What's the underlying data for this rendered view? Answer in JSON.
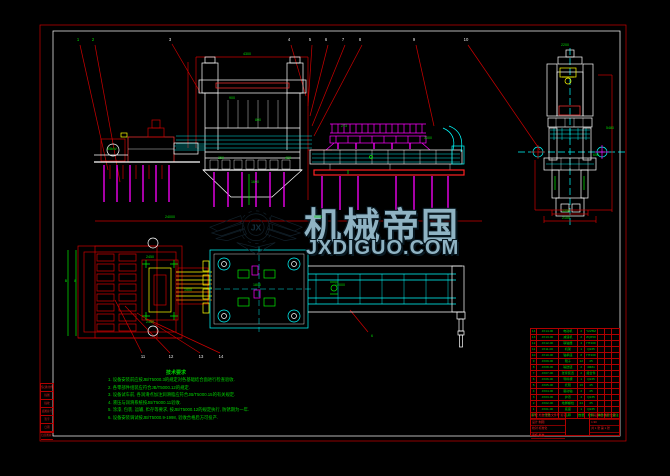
{
  "drawing": {
    "colors": {
      "background": "#000000",
      "frame_red": "#bb0000",
      "border_white": "#ffffff",
      "line_cyan": "#00ffff",
      "line_magenta": "#ff00ff",
      "line_green": "#00ee00",
      "line_yellow": "#ffff00",
      "watermark_blue": "#8fb3c3"
    },
    "watermark": {
      "title": "机械帝国",
      "site": "JXDIGUO.COM",
      "logo_monogram": "JX"
    },
    "notes": {
      "header": "技术要求",
      "lines": [
        "1. 设备安装前应按JB/T5000.3的规定对各基础结合面进行检查验收.",
        "2. 各零部件组装应符合JB/T5000.12的规定.",
        "3. 设备试车前, 各润滑点加注润滑脂应符合JB/T5000.15的有关规定.",
        "4. 液压与润滑系统按JB/T5000.11验收.",
        "5. 涂漆, 包装, 运输, 贮存等要求, 按JB/T5000.12的规定执行, 防锈期为一年.",
        "6. 设备安装调试按JB/T5000.9-1998, 验收合格后方可投产."
      ]
    },
    "bom": {
      "header": [
        "序号",
        "代号",
        "名称",
        "数量",
        "材料",
        "单件",
        "总计",
        "备注"
      ],
      "rows": [
        [
          "14",
          "JX14-00",
          "电动机",
          "2",
          "Y225M",
          "",
          "",
          ""
        ],
        [
          "13",
          "JX13-00",
          "减速机",
          "2",
          "ZQ650",
          "",
          "",
          ""
        ],
        [
          "12",
          "JX12-00",
          "联轴器",
          "4",
          "HT200",
          "",
          "",
          ""
        ],
        [
          "11",
          "JX11-00",
          "机架",
          "1",
          "Q235",
          "",
          "",
          ""
        ],
        [
          "10",
          "JX10-00",
          "轴承座",
          "8",
          "HT200",
          "",
          "",
          ""
        ],
        [
          "9",
          "JX09-00",
          "辊子",
          "12",
          "45",
          "",
          "",
          ""
        ],
        [
          "8",
          "JX08-00",
          "输送链",
          "2",
          "40Mn",
          "",
          "",
          ""
        ],
        [
          "7",
          "JX07-00",
          "张紧装置",
          "2",
          "组合件",
          "",
          "",
          ""
        ],
        [
          "6",
          "JX06-00",
          "导料槽",
          "1",
          "Q235",
          "",
          "",
          ""
        ],
        [
          "5",
          "JX05-00",
          "托辊",
          "16",
          "45",
          "",
          "",
          ""
        ],
        [
          "4",
          "JX04-00",
          "驱动轴",
          "2",
          "45",
          "",
          "",
          ""
        ],
        [
          "3",
          "JX03-00",
          "护罩",
          "4",
          "Q235",
          "",
          "",
          ""
        ],
        [
          "2",
          "JX02-00",
          "地脚螺栓",
          "24",
          "35",
          "",
          "",
          ""
        ],
        [
          "1",
          "JX01-00",
          "底座",
          "1",
          "Q235",
          "",
          "",
          ""
        ]
      ]
    },
    "title_block": {
      "left_rows": [
        "标记 处数 更改文件号 签字 日期",
        "设计  制图",
        "校对  标准化",
        "审核  批准"
      ],
      "right_rows": [
        "阶段标记  重量  比例",
        "1:30",
        "共 1 张  第 1 张"
      ]
    },
    "side_table_rows": [
      "借(通)用件登记",
      "描图",
      "描校",
      "底图总号",
      "签字",
      "日期",
      "旧底图总号"
    ],
    "annotations": {
      "balloons": [
        {
          "x": 78,
          "y": 38,
          "t": "1",
          "g": true
        },
        {
          "x": 93,
          "y": 38,
          "t": "2",
          "g": true
        },
        {
          "x": 170,
          "y": 38,
          "t": "3",
          "g": false
        },
        {
          "x": 289,
          "y": 38,
          "t": "4",
          "g": false
        },
        {
          "x": 310,
          "y": 38,
          "t": "5",
          "g": false
        },
        {
          "x": 326,
          "y": 38,
          "t": "6",
          "g": false
        },
        {
          "x": 343,
          "y": 38,
          "t": "7",
          "g": false
        },
        {
          "x": 360,
          "y": 38,
          "t": "8",
          "g": false
        },
        {
          "x": 414,
          "y": 38,
          "t": "9",
          "g": false
        },
        {
          "x": 466,
          "y": 38,
          "t": "10",
          "g": false
        },
        {
          "x": 143,
          "y": 355,
          "t": "11",
          "g": false
        },
        {
          "x": 171,
          "y": 355,
          "t": "12",
          "g": false
        },
        {
          "x": 201,
          "y": 355,
          "t": "13",
          "g": false
        },
        {
          "x": 221,
          "y": 355,
          "t": "14",
          "g": false
        }
      ],
      "dims": [
        {
          "x": 247,
          "y": 52,
          "t": "4300"
        },
        {
          "x": 170,
          "y": 215,
          "t": "24000"
        },
        {
          "x": 318,
          "y": 215,
          "t": "9000"
        },
        {
          "x": 232,
          "y": 96,
          "t": "900"
        },
        {
          "x": 258,
          "y": 118,
          "t": "800"
        },
        {
          "x": 221,
          "y": 156,
          "t": "350"
        },
        {
          "x": 288,
          "y": 156,
          "t": "420"
        },
        {
          "x": 255,
          "y": 180,
          "t": "1600"
        },
        {
          "x": 112,
          "y": 147,
          "t": "55kW"
        },
        {
          "x": 344,
          "y": 124,
          "t": "273"
        },
        {
          "x": 428,
          "y": 136,
          "t": "3000"
        },
        {
          "x": 565,
          "y": 43,
          "t": "2200"
        },
        {
          "x": 610,
          "y": 126,
          "t": "5480"
        },
        {
          "x": 596,
          "y": 153,
          "t": "650"
        },
        {
          "x": 566,
          "y": 209,
          "t": "1250"
        },
        {
          "x": 566,
          "y": 216,
          "t": "2100"
        },
        {
          "x": 66,
          "y": 279,
          "t": "B"
        },
        {
          "x": 75,
          "y": 279,
          "t": "8"
        },
        {
          "x": 150,
          "y": 255,
          "t": "2450"
        },
        {
          "x": 150,
          "y": 320,
          "t": "2450"
        },
        {
          "x": 188,
          "y": 288,
          "t": "1900"
        },
        {
          "x": 257,
          "y": 283,
          "t": "1800"
        },
        {
          "x": 340,
          "y": 283,
          "t": "12000"
        },
        {
          "x": 372,
          "y": 334,
          "t": "6"
        }
      ]
    }
  }
}
